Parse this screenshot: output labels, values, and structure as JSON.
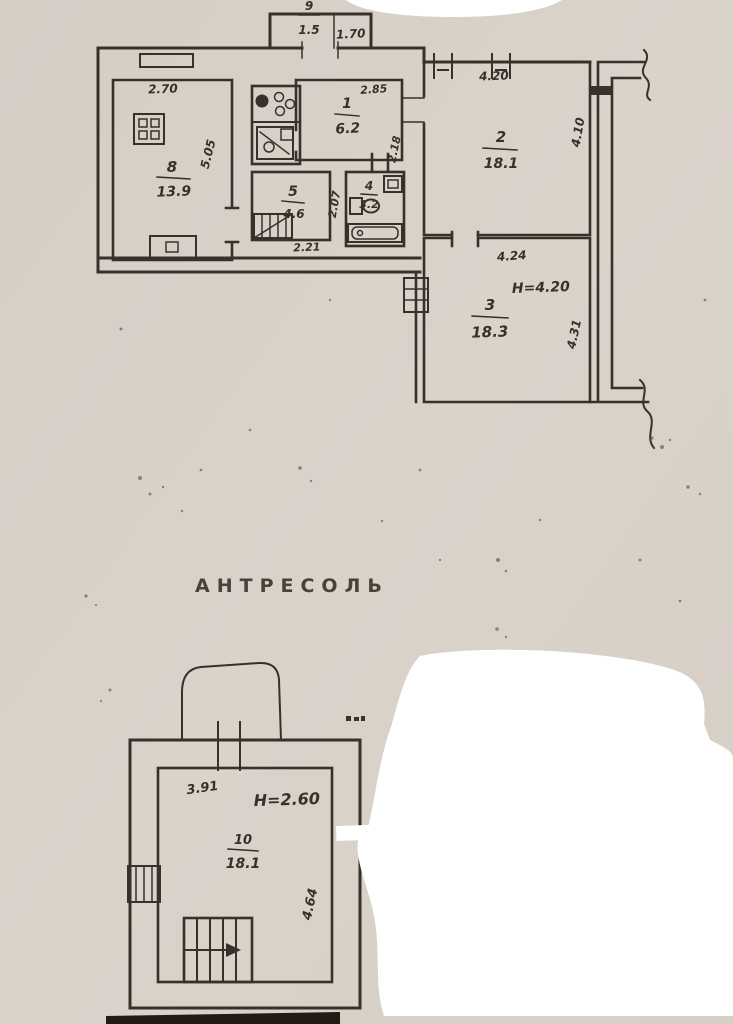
{
  "section": {
    "mezzanine_label": "АНТРЕСОЛЬ"
  },
  "main_plan": {
    "vestibule": {
      "number": "9",
      "area": "1.5",
      "width": "1.70"
    },
    "rooms": {
      "r1": {
        "number": "1",
        "area": "6.2",
        "top": "2.85",
        "side": "2.18"
      },
      "r2": {
        "number": "2",
        "area": "18.1",
        "top": "4.20",
        "side": "4.10"
      },
      "r3": {
        "number": "3",
        "area": "18.3",
        "top": "4.24",
        "side": "4.31",
        "height": "H=4.20"
      },
      "r4": {
        "number": "4",
        "area": "3.2"
      },
      "r5": {
        "number": "5",
        "area": "4.6",
        "bottom": "2.21",
        "side": "2.07"
      },
      "r8": {
        "number": "8",
        "area": "13.9",
        "top": "2.70",
        "side": "5.05"
      }
    }
  },
  "mezzanine_plan": {
    "room": {
      "number": "10",
      "area": "18.1",
      "top": "3.91",
      "side": "4.64",
      "height": "H=2.60"
    }
  },
  "colors": {
    "paper": "#d8d1c8",
    "ink": "#38302a",
    "redaction": "#ffffff",
    "photo_edge": "#221b15"
  }
}
